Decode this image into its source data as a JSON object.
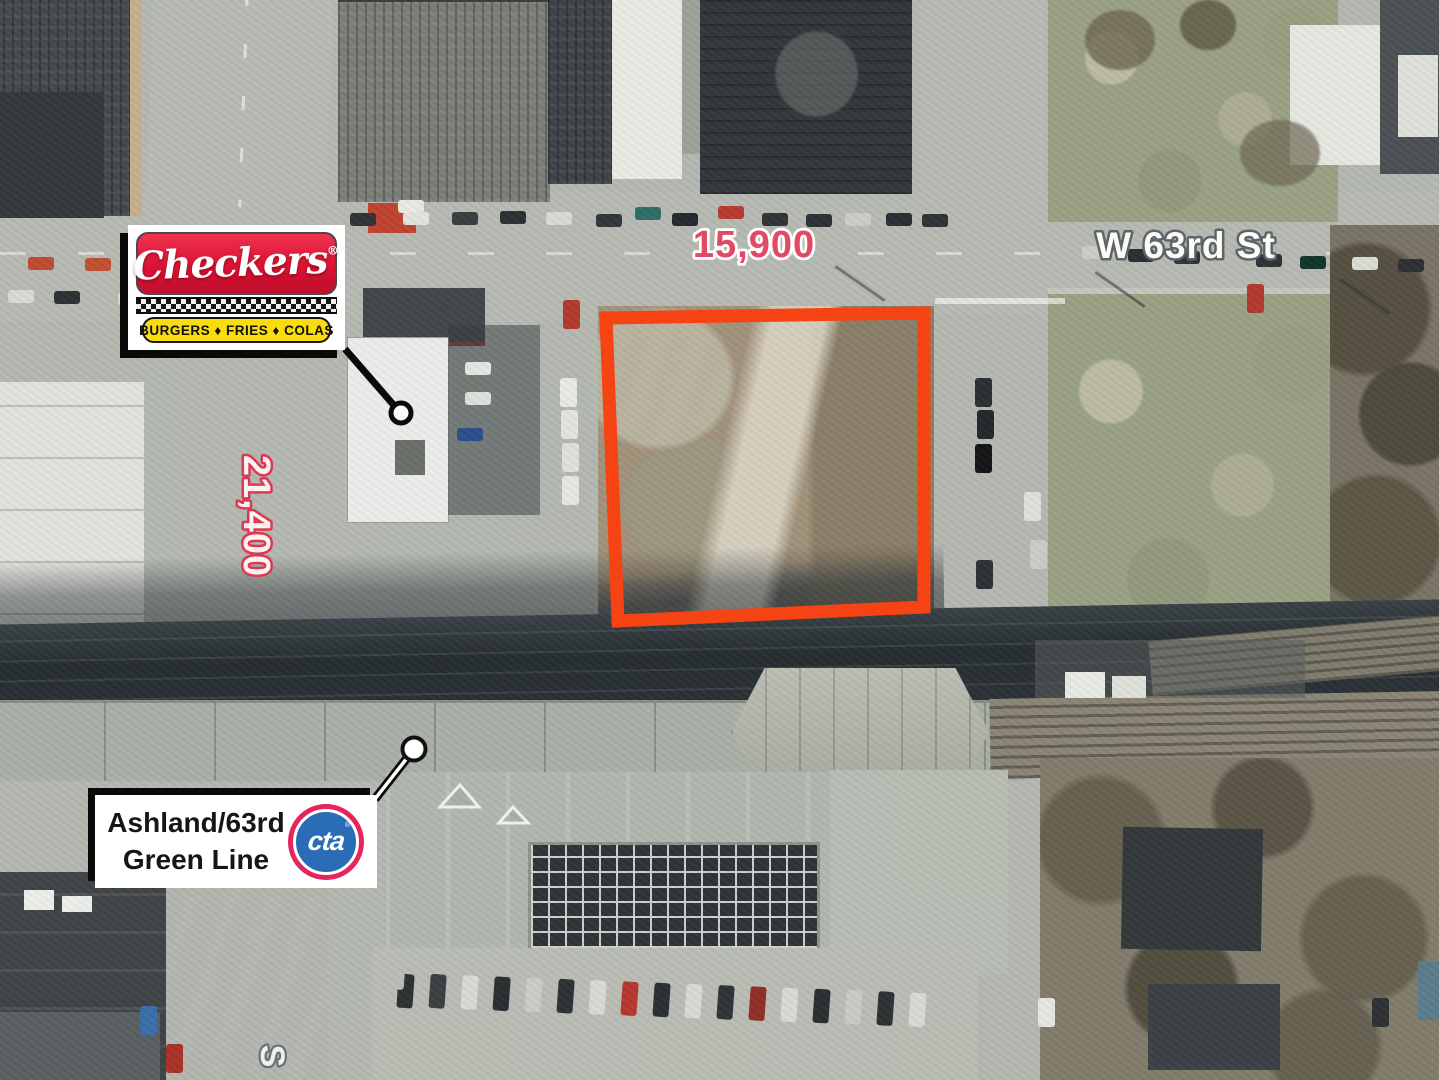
{
  "annotations": {
    "street_name": "W 63rd St",
    "traffic_count_63rd": "15,900",
    "traffic_count_ashland": "21,400",
    "partial_street_letter": "S"
  },
  "checkers_callout": {
    "brand": "Checkers",
    "registered_mark": "®",
    "tagline": "BURGERS ♦ FRIES ♦ COLAS"
  },
  "cta_callout": {
    "station_line1": "Ashland/63rd",
    "station_line2": "Green Line",
    "logo_text": "cta",
    "registered_mark": "®"
  },
  "colors": {
    "parcel_outline": "#f54313",
    "count_red_fill": "#e14a62",
    "count_red_stroke": "#da3a4f",
    "street_label_fill": "#fbfcf8",
    "checkers_red": "#d91334",
    "checkers_yellow": "#f8dc0c",
    "cta_blue": "#2a6cb5",
    "cta_ring": "#e3265e"
  }
}
